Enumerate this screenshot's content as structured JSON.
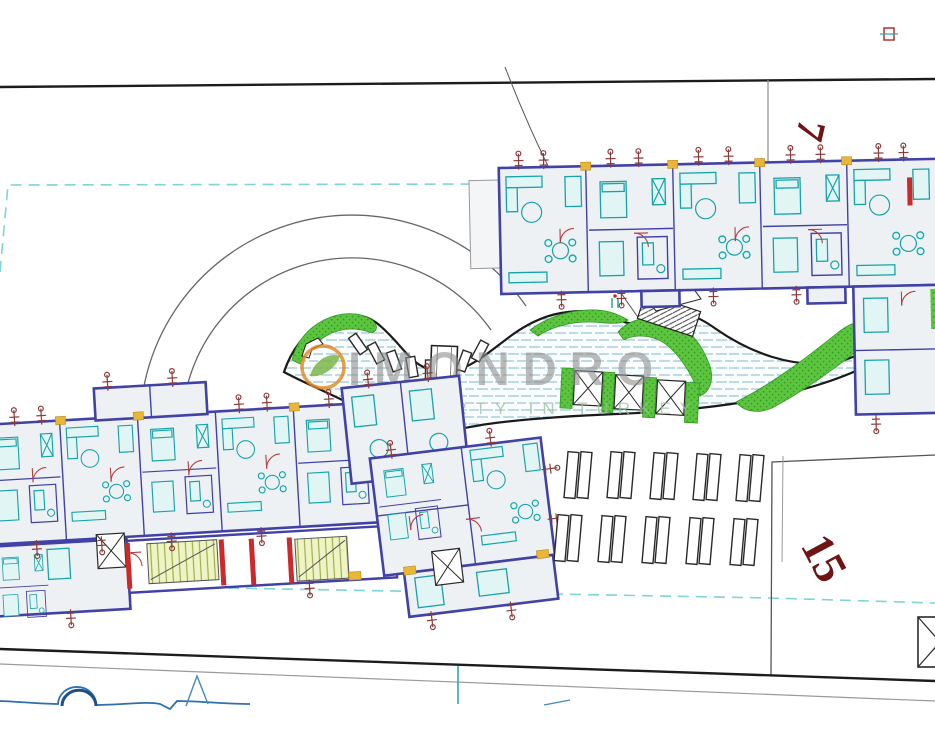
{
  "watermark": {
    "brand": "IMONDRO",
    "tagline": "PROPERTY IN TURKEY"
  },
  "plots": {
    "north": "7",
    "south": "15"
  },
  "colors": {
    "wall": "#4141a6",
    "furniture_teal": "#17a3a8",
    "floor": "#eef1f4",
    "landscaping_green": "#5cc43e",
    "landscaping_green_dark": "#2f9a22",
    "wall_red_segment": "#cc2a2a",
    "marker_red": "#8d3a3a",
    "junction_yellow": "#e9b637",
    "pool_water_line": "#79b0c7",
    "parcel_dash_cyan": "#7fd4d4",
    "plot_label": "#6e1414",
    "watermark_gray": "#8f8f8f",
    "watermark_green": "#9dbda0",
    "road_black": "#1c1c1c",
    "contour_blue": "#2f6fae"
  }
}
